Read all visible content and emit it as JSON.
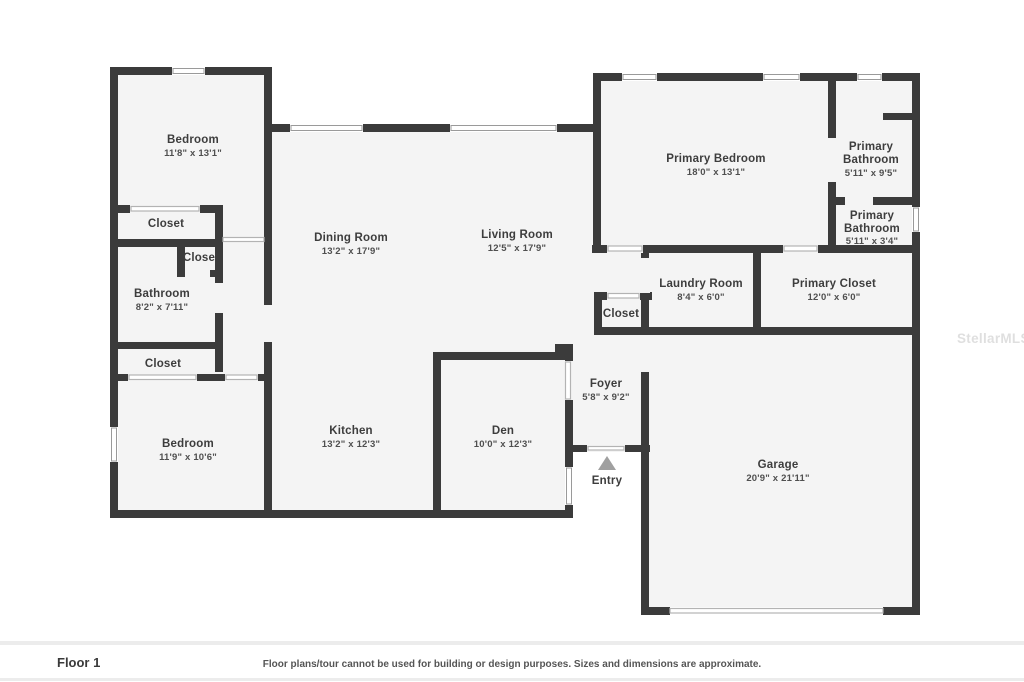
{
  "floor_plan": {
    "wall_color": "#3b3b3b",
    "room_fill_color": "#f4f4f4",
    "rooms": [
      {
        "lines": [
          "Bedroom"
        ],
        "dims": "11'8\" x 13'1\""
      },
      {
        "lines": [
          "Closet"
        ],
        "dims": ""
      },
      {
        "lines": [
          "Closet"
        ],
        "dims": ""
      },
      {
        "lines": [
          "Bathroom"
        ],
        "dims": "8'2\" x 7'11\""
      },
      {
        "lines": [
          "Closet"
        ],
        "dims": ""
      },
      {
        "lines": [
          "Bedroom"
        ],
        "dims": "11'9\" x 10'6\""
      },
      {
        "lines": [
          "Dining Room"
        ],
        "dims": "13'2\" x 17'9\""
      },
      {
        "lines": [
          "Living Room"
        ],
        "dims": "12'5\" x 17'9\""
      },
      {
        "lines": [
          "Kitchen"
        ],
        "dims": "13'2\" x 12'3\""
      },
      {
        "lines": [
          "Den"
        ],
        "dims": "10'0\" x 12'3\""
      },
      {
        "lines": [
          "Foyer"
        ],
        "dims": "5'8\" x 9'2\""
      },
      {
        "lines": [
          "Primary Bedroom"
        ],
        "dims": "18'0\" x 13'1\""
      },
      {
        "lines": [
          "Primary",
          "Bathroom"
        ],
        "dims": "5'11\" x 9'5\""
      },
      {
        "lines": [
          "Primary",
          "Bathroom"
        ],
        "dims": "5'11\" x 3'4\""
      },
      {
        "lines": [
          "Laundry Room"
        ],
        "dims": "8'4\" x 6'0\""
      },
      {
        "lines": [
          "Closet"
        ],
        "dims": ""
      },
      {
        "lines": [
          "Primary Closet"
        ],
        "dims": "12'0\" x 6'0\""
      },
      {
        "lines": [
          "Garage"
        ],
        "dims": "20'9\" x 21'11\""
      },
      {
        "lines": [
          "Entry"
        ],
        "dims": ""
      }
    ]
  },
  "footer": {
    "floor_label": "Floor 1",
    "disclaimer": "Floor plans/tour cannot be used for building or design purposes. Sizes and dimensions are approximate."
  },
  "watermark": "StellarMLS"
}
